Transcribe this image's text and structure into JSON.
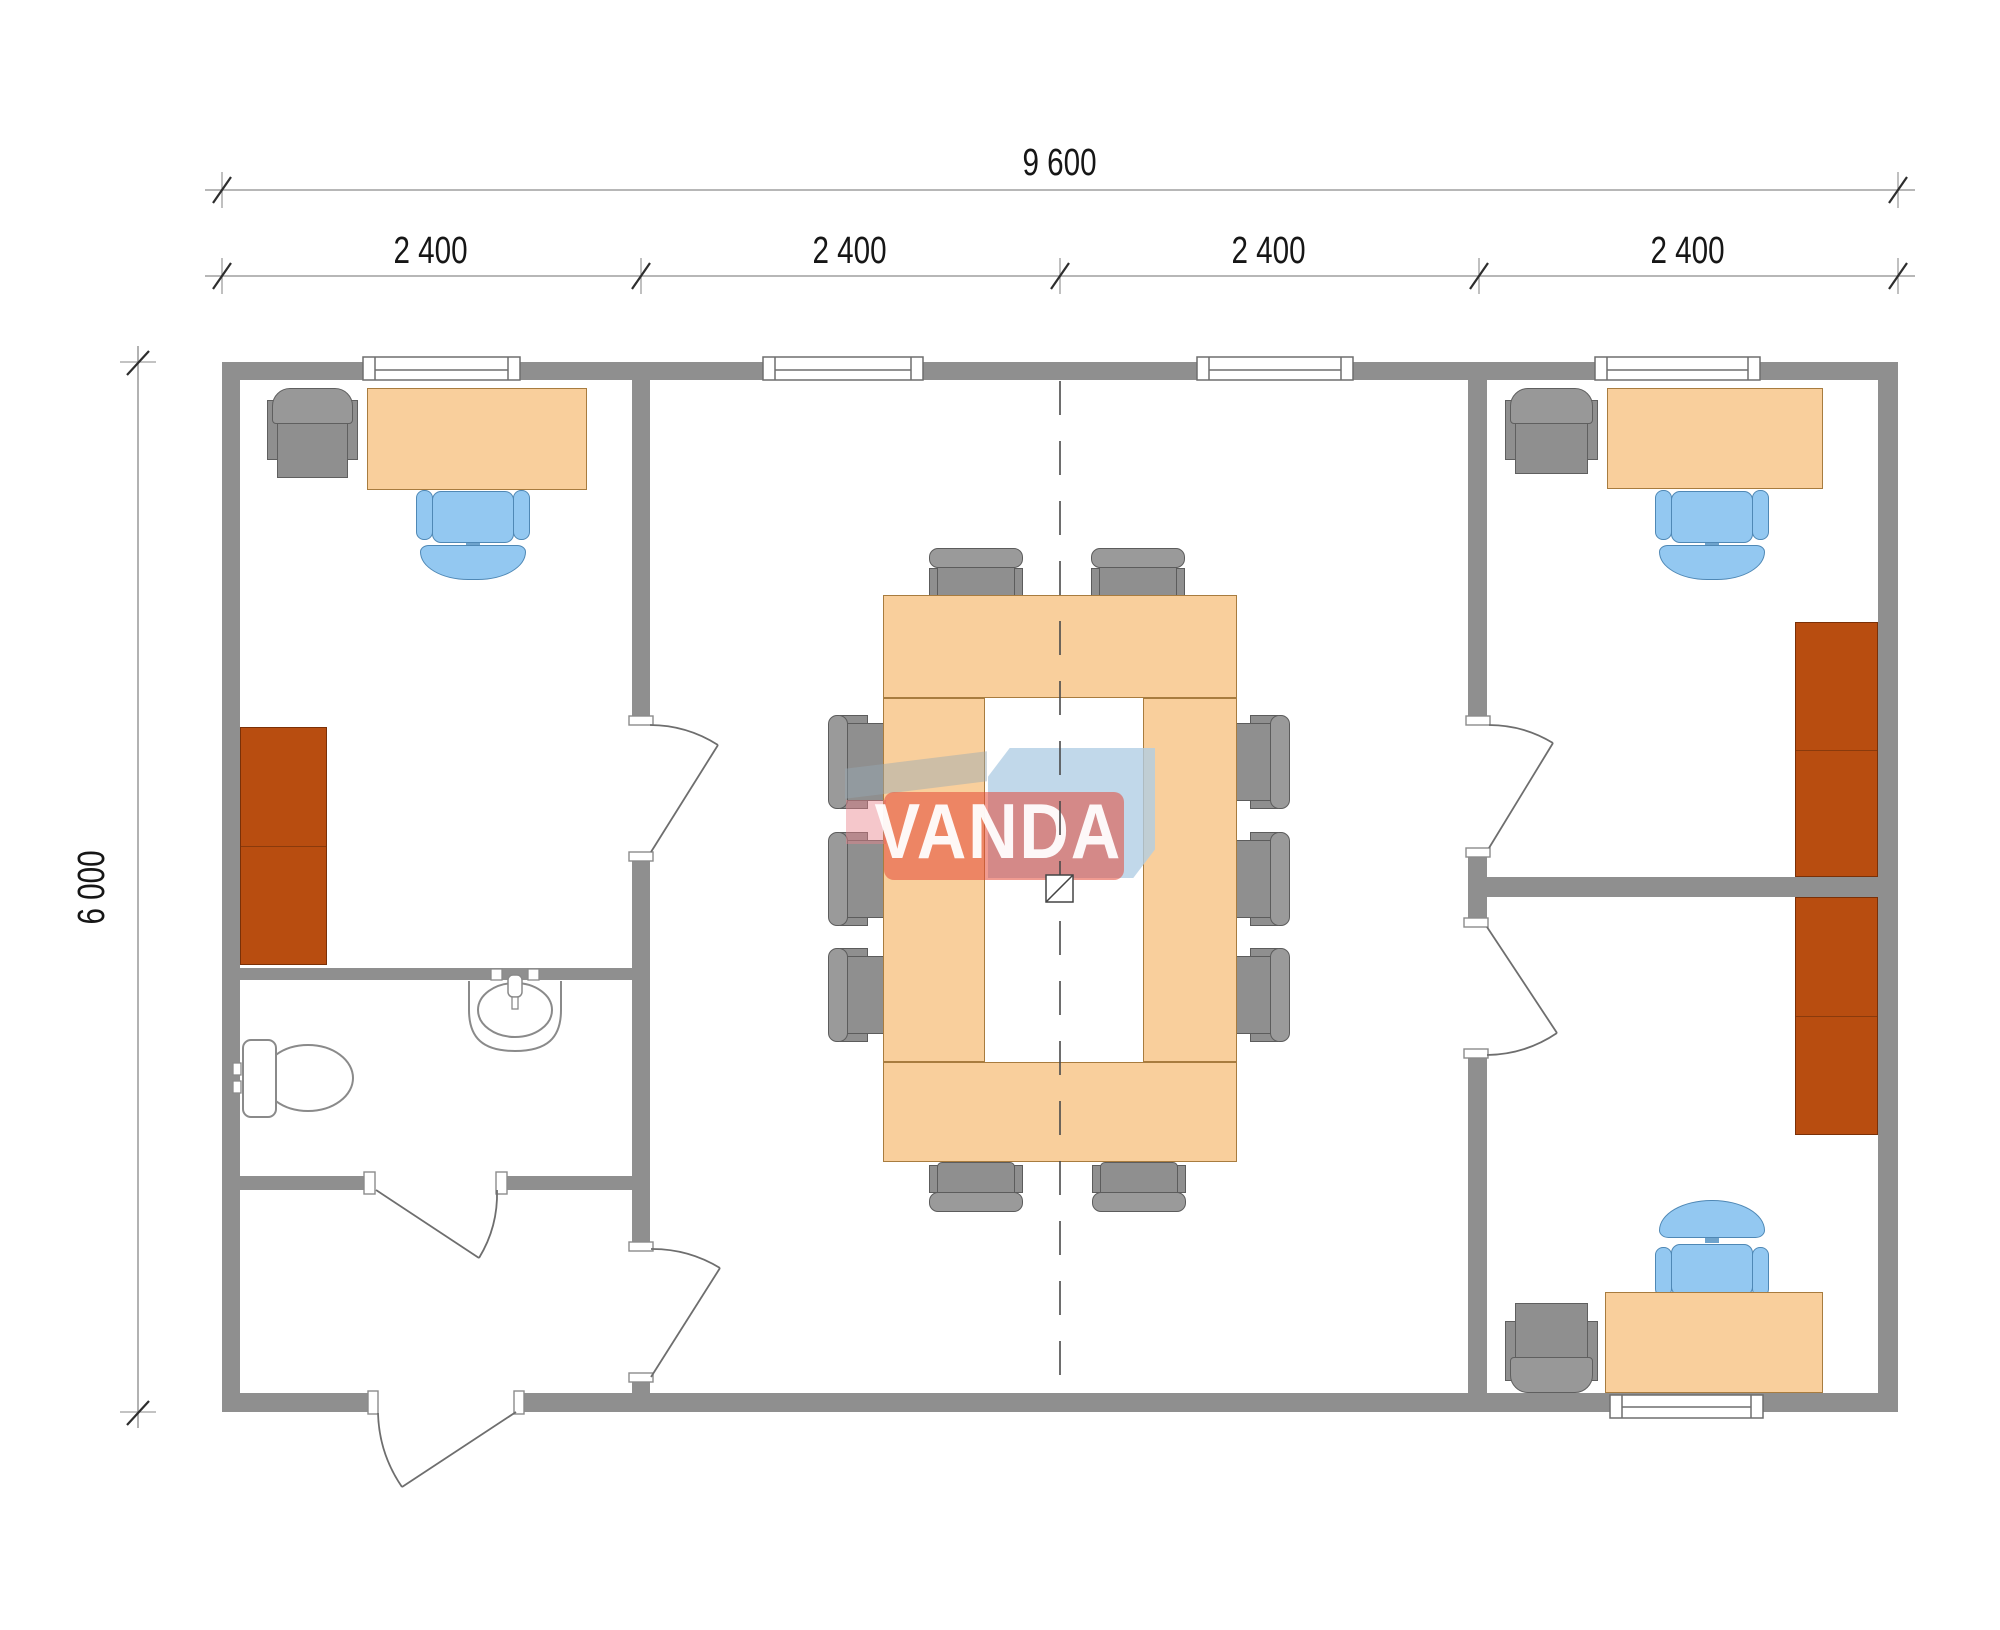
{
  "watermark": {
    "brand": "VANDA"
  },
  "dimensions": {
    "overall_width": "9 600",
    "overall_height": "6 000",
    "modules": [
      "2 400",
      "2 400",
      "2 400",
      "2 400"
    ]
  },
  "colors": {
    "wall_gray": "#8f8f8f",
    "desk_peach": "#f9cf9c",
    "chair_blue": "#93c8f1",
    "chair_gray": "#949494",
    "cabinet_brown": "#b84d10",
    "logo_red": "#e2493b",
    "logo_blue": "#b9d3e8"
  }
}
